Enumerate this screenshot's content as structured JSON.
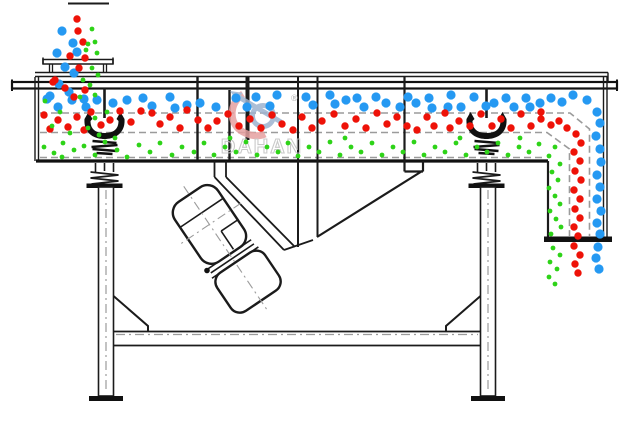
{
  "watermark": {
    "brand": "DAHAN",
    "registered": "®",
    "text_color": "#c0c0c0",
    "swirl_blue": "#9db3cf",
    "swirl_red": "#e6a0a0"
  },
  "colors": {
    "line": "#1b1b1b",
    "dash": "#9b9b9b",
    "blue": "#2599f2",
    "red": "#ee1208",
    "green": "#2ed318",
    "background": "#ffffff"
  },
  "particles": {
    "blue_large": {
      "color": "#2599f2",
      "radius": 4.6,
      "points": [
        [
          62,
          31
        ],
        [
          73,
          43
        ],
        [
          57,
          53
        ],
        [
          77,
          52
        ],
        [
          65,
          67
        ],
        [
          74,
          73
        ],
        [
          59,
          84
        ],
        [
          69,
          92
        ],
        [
          50,
          96
        ],
        [
          84,
          99
        ],
        [
          47,
          99
        ],
        [
          58,
          107
        ],
        [
          72,
          100
        ],
        [
          86,
          107
        ],
        [
          97,
          100
        ],
        [
          113,
          103
        ],
        [
          127,
          100
        ],
        [
          143,
          98
        ],
        [
          152,
          106
        ],
        [
          170,
          97
        ],
        [
          175,
          108
        ],
        [
          187,
          105
        ],
        [
          200,
          103
        ],
        [
          216,
          107
        ],
        [
          236,
          98
        ],
        [
          247,
          107
        ],
        [
          256,
          97
        ],
        [
          270,
          106
        ],
        [
          277,
          95
        ],
        [
          306,
          97
        ],
        [
          313,
          105
        ],
        [
          330,
          95
        ],
        [
          335,
          104
        ],
        [
          346,
          100
        ],
        [
          357,
          98
        ],
        [
          364,
          107
        ],
        [
          376,
          97
        ],
        [
          386,
          103
        ],
        [
          400,
          107
        ],
        [
          408,
          97
        ],
        [
          416,
          103
        ],
        [
          429,
          98
        ],
        [
          432,
          108
        ],
        [
          448,
          107
        ],
        [
          451,
          95
        ],
        [
          461,
          107
        ],
        [
          474,
          97
        ],
        [
          486,
          106
        ],
        [
          494,
          103
        ],
        [
          506,
          98
        ],
        [
          514,
          107
        ],
        [
          526,
          98
        ],
        [
          530,
          107
        ],
        [
          540,
          103
        ],
        [
          551,
          98
        ],
        [
          562,
          102
        ],
        [
          573,
          95
        ],
        [
          587,
          100
        ],
        [
          597,
          112
        ],
        [
          600,
          123
        ],
        [
          596,
          136
        ],
        [
          600,
          149
        ],
        [
          601,
          162
        ],
        [
          597,
          175
        ],
        [
          600,
          187
        ],
        [
          597,
          199
        ],
        [
          601,
          211
        ],
        [
          597,
          223
        ],
        [
          600,
          234
        ],
        [
          598,
          247
        ],
        [
          596,
          258
        ],
        [
          599,
          269
        ]
      ]
    },
    "red_medium": {
      "color": "#ee1208",
      "radius": 3.7,
      "points": [
        [
          77,
          19
        ],
        [
          78,
          31
        ],
        [
          83,
          42
        ],
        [
          70,
          56
        ],
        [
          85,
          58
        ],
        [
          79,
          68
        ],
        [
          55,
          80
        ],
        [
          65,
          88
        ],
        [
          85,
          90
        ],
        [
          74,
          97
        ],
        [
          53,
          82
        ],
        [
          44,
          115
        ],
        [
          50,
          129
        ],
        [
          58,
          120
        ],
        [
          68,
          127
        ],
        [
          77,
          117
        ],
        [
          84,
          130
        ],
        [
          91,
          112
        ],
        [
          101,
          125
        ],
        [
          110,
          120
        ],
        [
          120,
          111
        ],
        [
          131,
          122
        ],
        [
          141,
          111
        ],
        [
          152,
          113
        ],
        [
          160,
          124
        ],
        [
          170,
          117
        ],
        [
          180,
          128
        ],
        [
          187,
          110
        ],
        [
          198,
          120
        ],
        [
          208,
          128
        ],
        [
          217,
          121
        ],
        [
          228,
          114
        ],
        [
          239,
          126
        ],
        [
          250,
          119
        ],
        [
          261,
          128
        ],
        [
          272,
          115
        ],
        [
          282,
          124
        ],
        [
          293,
          130
        ],
        [
          302,
          117
        ],
        [
          312,
          128
        ],
        [
          322,
          121
        ],
        [
          334,
          114
        ],
        [
          345,
          126
        ],
        [
          356,
          119
        ],
        [
          366,
          128
        ],
        [
          377,
          113
        ],
        [
          387,
          124
        ],
        [
          397,
          117
        ],
        [
          407,
          126
        ],
        [
          417,
          130
        ],
        [
          427,
          117
        ],
        [
          434,
          126
        ],
        [
          445,
          113
        ],
        [
          450,
          128
        ],
        [
          459,
          121
        ],
        [
          470,
          126
        ],
        [
          481,
          114
        ],
        [
          492,
          126
        ],
        [
          501,
          119
        ],
        [
          511,
          128
        ],
        [
          521,
          114
        ],
        [
          531,
          126
        ],
        [
          541,
          119
        ],
        [
          551,
          125
        ],
        [
          559,
          121
        ],
        [
          541,
          112
        ],
        [
          567,
          128
        ],
        [
          576,
          134
        ],
        [
          581,
          143
        ],
        [
          574,
          152
        ],
        [
          580,
          161
        ],
        [
          575,
          171
        ],
        [
          581,
          180
        ],
        [
          574,
          190
        ],
        [
          580,
          199
        ],
        [
          575,
          209
        ],
        [
          580,
          218
        ],
        [
          574,
          227
        ],
        [
          578,
          236
        ],
        [
          574,
          246
        ],
        [
          580,
          255
        ],
        [
          575,
          264
        ],
        [
          578,
          273
        ]
      ]
    },
    "green_fine": {
      "color": "#2ed318",
      "radius": 2.4,
      "points": [
        [
          92,
          29
        ],
        [
          95,
          42
        ],
        [
          88,
          44
        ],
        [
          97,
          53
        ],
        [
          86,
          50
        ],
        [
          92,
          68
        ],
        [
          98,
          75
        ],
        [
          90,
          85
        ],
        [
          95,
          95
        ],
        [
          83,
          80
        ],
        [
          45,
          101
        ],
        [
          60,
          112
        ],
        [
          80,
          97
        ],
        [
          95,
          118
        ],
        [
          52,
          126
        ],
        [
          88,
          128
        ],
        [
          99,
          135
        ],
        [
          70,
          133
        ],
        [
          107,
          112
        ],
        [
          44,
          147
        ],
        [
          54,
          153
        ],
        [
          63,
          143
        ],
        [
          74,
          150
        ],
        [
          62,
          157
        ],
        [
          84,
          146
        ],
        [
          95,
          155
        ],
        [
          105,
          142
        ],
        [
          117,
          150
        ],
        [
          127,
          157
        ],
        [
          139,
          145
        ],
        [
          150,
          152
        ],
        [
          160,
          143
        ],
        [
          172,
          155
        ],
        [
          182,
          147
        ],
        [
          194,
          152
        ],
        [
          204,
          143
        ],
        [
          214,
          155
        ],
        [
          225,
          147
        ],
        [
          236,
          152
        ],
        [
          246,
          142
        ],
        [
          257,
          155
        ],
        [
          267,
          147
        ],
        [
          278,
          152
        ],
        [
          288,
          143
        ],
        [
          298,
          156
        ],
        [
          309,
          147
        ],
        [
          319,
          152
        ],
        [
          330,
          142
        ],
        [
          340,
          155
        ],
        [
          351,
          147
        ],
        [
          361,
          152
        ],
        [
          372,
          143
        ],
        [
          382,
          155
        ],
        [
          393,
          147
        ],
        [
          403,
          152
        ],
        [
          414,
          142
        ],
        [
          424,
          155
        ],
        [
          435,
          147
        ],
        [
          445,
          152
        ],
        [
          456,
          143
        ],
        [
          466,
          155
        ],
        [
          477,
          147
        ],
        [
          487,
          152
        ],
        [
          498,
          143
        ],
        [
          508,
          155
        ],
        [
          519,
          147
        ],
        [
          529,
          152
        ],
        [
          539,
          144
        ],
        [
          115,
          138
        ],
        [
          230,
          138
        ],
        [
          345,
          138
        ],
        [
          460,
          138
        ],
        [
          520,
          138
        ],
        [
          555,
          147
        ],
        [
          549,
          156
        ],
        [
          560,
          164
        ],
        [
          552,
          172
        ],
        [
          558,
          180
        ],
        [
          549,
          188
        ],
        [
          555,
          196
        ],
        [
          560,
          204
        ],
        [
          550,
          211
        ],
        [
          556,
          219
        ],
        [
          561,
          227
        ],
        [
          551,
          234
        ],
        [
          553,
          248
        ],
        [
          560,
          255
        ],
        [
          550,
          262
        ],
        [
          557,
          269
        ],
        [
          549,
          277
        ],
        [
          555,
          284
        ]
      ]
    }
  }
}
